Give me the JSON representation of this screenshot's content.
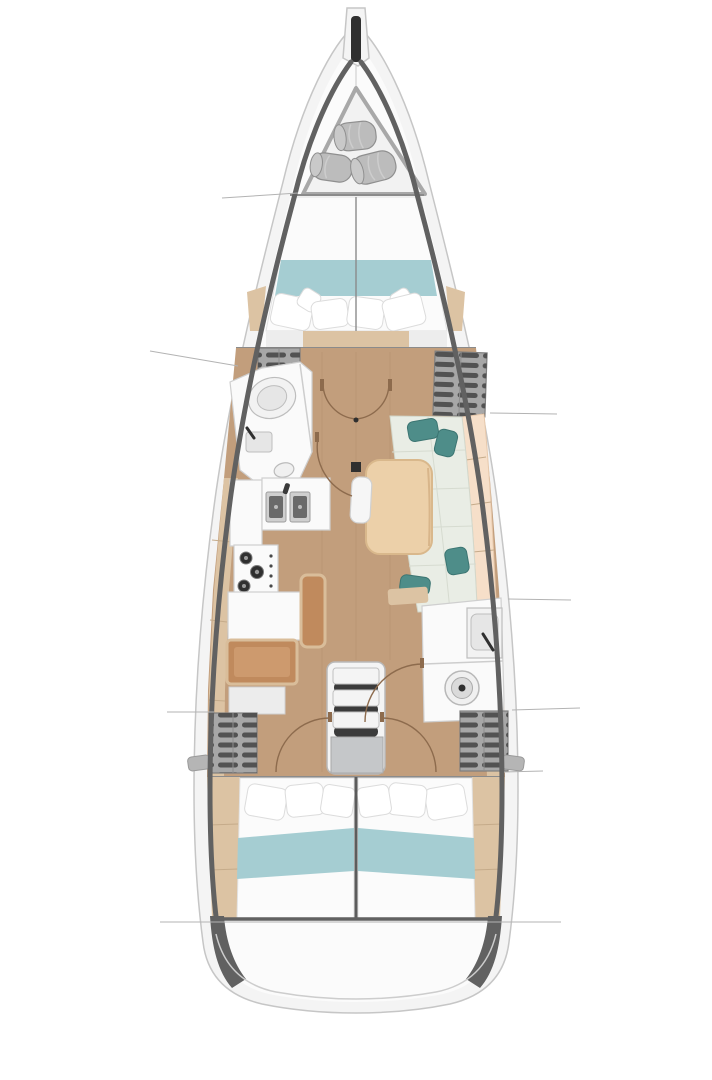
{
  "meta": {
    "description": "Top-view interior layout plan of a sailing yacht: bow sail locker, V-berth owner cabin, forward head, galley, salon with settee and table, nav station, companionway stairs, aft head, and two aft double cabins",
    "orientation": "bow-up",
    "visible_text": []
  },
  "palette": {
    "bg": "#ffffff",
    "deck": "#f4f4f4",
    "hull_edge": "#c6c6c6",
    "bulwark": "#616161",
    "interior": "#fbfbfb",
    "floor": "#c29e7c",
    "plank": "#a98a66",
    "trim": "#dcc3a3",
    "trim_seam": "#c5ab8a",
    "room": "#fafafa",
    "room_edge": "#cfcfcf",
    "bed": "#fbfbfb",
    "bed_edge": "#e2e2e2",
    "teal_band": "#a5cdd2",
    "pillow": "#ffffff",
    "pillow_edge": "#dcdcdc",
    "seat": "#e9ede5",
    "seat_edge": "#d3d8cc",
    "seat_seam": "#d6dbd0",
    "backrest": "#f6dfc9",
    "backrest_edge": "#e6c8ab",
    "teal_pillow": "#4e8d89",
    "teal_pillow_edge": "#3c7572",
    "table": "#ecd0a9",
    "table_edge": "#d9b88c",
    "locker": "#a7a7a7",
    "locker_edge": "#7e7e7e",
    "slat": "#525252",
    "roll": "#bcbcbc",
    "roll_end": "#c9c9c9",
    "roll_edge": "#8f8f8f",
    "fixture": "#f2f2f2",
    "fixture2": "#e6e6e6",
    "fixture_edge": "#bdbdbd",
    "sink": "#cfcfcf",
    "sink_bowl": "#6a6a6a",
    "dark": "#2f2f2f",
    "stair": "#f4f4f4",
    "stair_shadow": "#3b3b3b",
    "landing": "#c5c7c9",
    "nav": "#c08a5d",
    "nav_light": "#cd9a6e",
    "nav_frame": "#d9bd9a",
    "door_arc": "#8d6b4d",
    "section_line": "#b3b3b3",
    "struct": "#8b8b8b"
  },
  "components": [
    "bowsprit-anchor-channel",
    "sail-locker",
    "sail-rolls",
    "v-berth-bed",
    "forward-head",
    "galley-double-sink",
    "galley-stove",
    "salon-settee",
    "salon-table",
    "mast-step",
    "nav-desk",
    "nav-seat",
    "companionway-stairs",
    "aft-head-toilet",
    "aft-head-sink",
    "aft-cabin-port-bed",
    "aft-cabin-starboard-bed",
    "storage-lockers",
    "section-lines",
    "door-swing-arcs"
  ]
}
